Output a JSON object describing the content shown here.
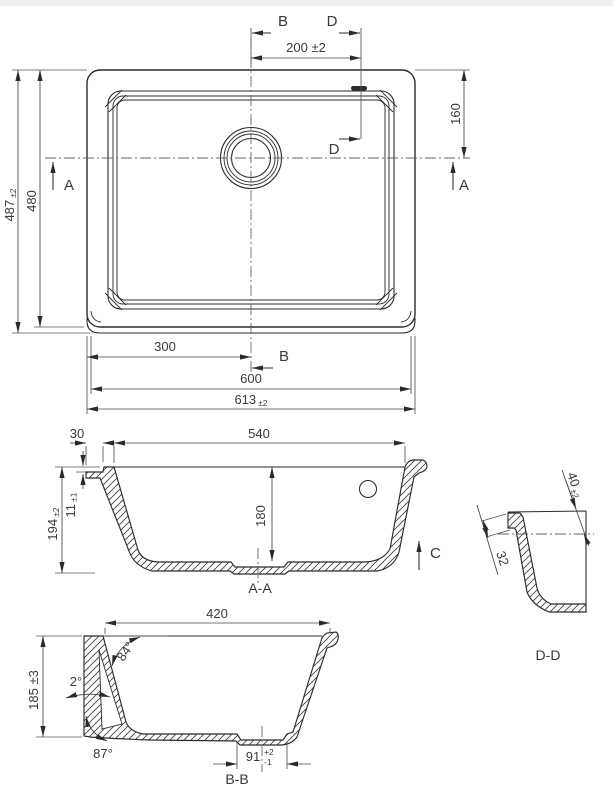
{
  "drawing": {
    "plan": {
      "section_b_top": "B",
      "section_d_top": "D",
      "dim_200": "200 ±2",
      "dim_160": "160",
      "dim_487": "487",
      "dim_487_tol": "±2",
      "dim_480": "480",
      "section_a_left": "A",
      "section_a_right": "A",
      "dim_300": "300",
      "section_b_bottom": "B",
      "section_d_mid": "D",
      "dim_600": "600",
      "dim_613": "613",
      "dim_613_tol": "±2"
    },
    "section_aa": {
      "dim_30": "30",
      "dim_540": "540",
      "dim_11": "11",
      "dim_11_tol": "±1",
      "dim_194": "194",
      "dim_194_tol": "±2",
      "dim_180": "180",
      "arrow_c": "C",
      "title": "A-A"
    },
    "section_bb": {
      "dim_420": "420",
      "dim_185": "185 ±3",
      "angle_84": "84°",
      "angle_2": "2°",
      "angle_87": "87°",
      "dim_91": "91",
      "dim_91_tol_plus": "+2",
      "dim_91_tol_minus": "-1",
      "title": "B-B"
    },
    "detail_dd": {
      "dim_40": "40",
      "dim_40_tol": "±2",
      "dim_32": "32",
      "title": "D-D"
    }
  }
}
